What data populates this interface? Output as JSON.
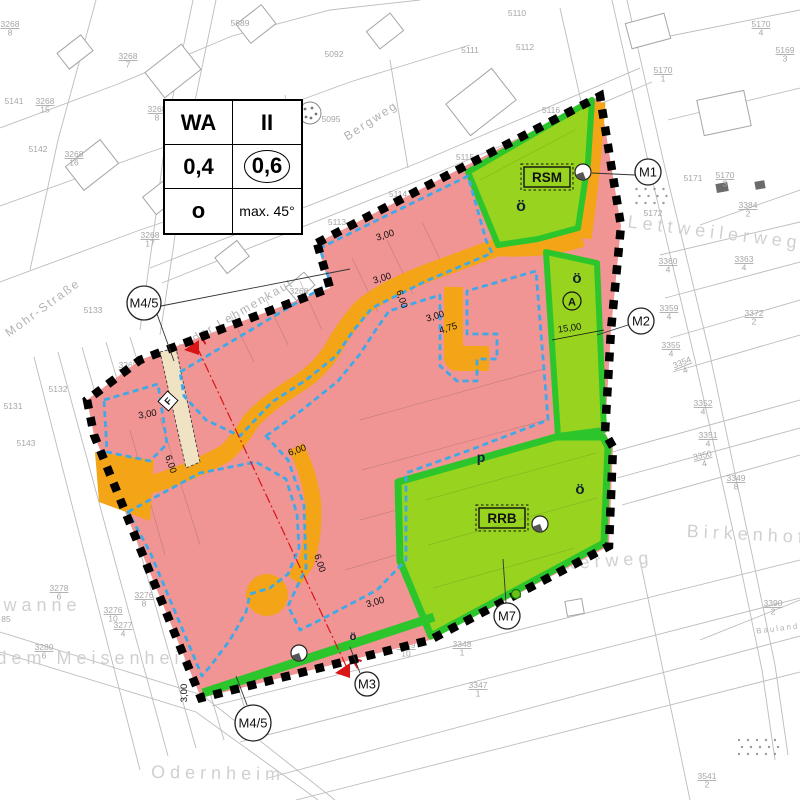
{
  "map_type": "Bebauungsplan (zoning development plan)",
  "colors": {
    "residential_pink": "#f19494",
    "road_orange": "#f3a517",
    "green_fill": "#97d31f",
    "green_band": "#2cc62c",
    "building_limit_blue": "#3fa9e8",
    "section_red": "#d91616",
    "boundary_black": "#000000",
    "cadastre_gray": "#bcbcbc",
    "label_gray": "#a6a6a6",
    "footpath_cream": "#efe3c4"
  },
  "legend": {
    "rows": [
      {
        "left": "WA",
        "right": "II"
      },
      {
        "left": "0,4",
        "right": "0,6"
      },
      {
        "left": "o",
        "right": "max. 45°"
      }
    ]
  },
  "area_boxes": {
    "rsm": {
      "label": "RSM",
      "x": 547,
      "y": 177
    },
    "rrb": {
      "label": "RRB",
      "x": 502,
      "y": 518
    }
  },
  "green_labels": [
    {
      "t": "ö",
      "x": 521,
      "y": 211,
      "s": 16
    },
    {
      "t": "ö",
      "x": 577,
      "y": 283,
      "s": 15
    },
    {
      "t": "ö",
      "x": 580,
      "y": 494,
      "s": 15
    },
    {
      "t": "ö",
      "x": 353,
      "y": 640,
      "s": 11
    },
    {
      "t": "p",
      "x": 481,
      "y": 462,
      "s": 14
    }
  ],
  "circled_a": {
    "label": "A",
    "x": 572,
    "y": 301
  },
  "f_symbol": {
    "label": "F",
    "x": 168,
    "y": 401
  },
  "section_markers": {
    "label": "A",
    "line": [
      [
        197,
        347
      ],
      [
        348,
        670
      ]
    ],
    "triangles": [
      {
        "x": 197,
        "y": 347,
        "ax": 208,
        "ay": 340
      },
      {
        "x": 348,
        "y": 670,
        "ax": 360,
        "ay": 664
      }
    ]
  },
  "markers": [
    {
      "label": "M1",
      "x": 648,
      "y": 172,
      "r": 13,
      "leaders": [
        [
          [
            635,
            175
          ],
          [
            592,
            173
          ]
        ]
      ]
    },
    {
      "label": "M2",
      "x": 641,
      "y": 321,
      "r": 13,
      "leaders": [
        [
          [
            628,
            325
          ],
          [
            597,
            335
          ]
        ]
      ]
    },
    {
      "label": "M3",
      "x": 367,
      "y": 684,
      "r": 12,
      "leaders": [
        [
          [
            360,
            673
          ],
          [
            350,
            647
          ]
        ]
      ]
    },
    {
      "label": "M4/5",
      "x": 144,
      "y": 303,
      "r": 17,
      "leaders": [
        [
          [
            157,
            314
          ],
          [
            174,
            361
          ]
        ],
        [
          [
            161,
            306
          ],
          [
            350,
            269
          ]
        ]
      ]
    },
    {
      "label": "M4/5",
      "x": 253,
      "y": 723,
      "r": 18,
      "leaders": [
        [
          [
            247,
            705
          ],
          [
            236,
            676
          ]
        ]
      ]
    },
    {
      "label": "M7",
      "x": 507,
      "y": 616,
      "r": 13,
      "leaders": [
        [
          [
            506,
            603
          ],
          [
            503,
            559
          ]
        ]
      ]
    }
  ],
  "dimensions": [
    {
      "t": "3,00",
      "x": 386,
      "y": 238,
      "r": -17
    },
    {
      "t": "3,00",
      "x": 383,
      "y": 281,
      "r": -17
    },
    {
      "t": "6,00",
      "x": 399,
      "y": 300,
      "r": 72
    },
    {
      "t": "3,00",
      "x": 436,
      "y": 319,
      "r": -17
    },
    {
      "t": "4,75",
      "x": 449,
      "y": 331,
      "r": -17
    },
    {
      "t": "15,00",
      "x": 570,
      "y": 331,
      "r": -8
    },
    {
      "t": "3,00",
      "x": 148,
      "y": 417,
      "r": -10
    },
    {
      "t": "6,00",
      "x": 168,
      "y": 465,
      "r": 72
    },
    {
      "t": "6,00",
      "x": 298,
      "y": 453,
      "r": -18
    },
    {
      "t": "6,00",
      "x": 317,
      "y": 564,
      "r": 72
    },
    {
      "t": "3,00",
      "x": 376,
      "y": 605,
      "r": -16
    },
    {
      "t": "3,00",
      "x": 187,
      "y": 693,
      "r": -90
    }
  ],
  "street_names": [
    {
      "t": "Bergweg",
      "x": 373,
      "y": 124,
      "r": -33,
      "size": "sm"
    },
    {
      "t": "Mohr-Straße",
      "x": 45,
      "y": 311,
      "r": -36,
      "size": "sm"
    },
    {
      "t": "Auf der Lehmenkaut",
      "x": 232,
      "y": 321,
      "r": -30,
      "size": "sm"
    },
    {
      "t": "Lettweilerweg",
      "x": 714,
      "y": 238,
      "r": 7,
      "size": "lg"
    },
    {
      "t": "Birkenhof",
      "x": 747,
      "y": 540,
      "r": 3,
      "size": "lg"
    },
    {
      "t": "Odernheim",
      "x": 218,
      "y": 779,
      "r": 1,
      "size": "lg"
    },
    {
      "t": "dem Meisenheimer",
      "x": 113,
      "y": 664,
      "r": 0,
      "size": "lg"
    },
    {
      "t": "ewanne",
      "x": 35,
      "y": 611,
      "r": 0,
      "size": "lg"
    },
    {
      "t": "Am Leinackerweg",
      "x": 545,
      "y": 571,
      "r": -4,
      "size": "lg"
    },
    {
      "t": "Bauland",
      "x": 778,
      "y": 631,
      "r": -7,
      "size": "xs"
    }
  ],
  "parcel_labels": [
    {
      "t": "3268/8",
      "x": 10,
      "y": 27
    },
    {
      "t": "5889",
      "x": 240,
      "y": 26
    },
    {
      "t": "3268/7",
      "x": 128,
      "y": 59
    },
    {
      "t": "5141",
      "x": 14,
      "y": 104
    },
    {
      "t": "3268/15",
      "x": 45,
      "y": 104
    },
    {
      "t": "3268/8",
      "x": 157,
      "y": 112
    },
    {
      "t": "5142",
      "x": 38,
      "y": 152
    },
    {
      "t": "3268/16",
      "x": 74,
      "y": 157
    },
    {
      "t": "3268/17",
      "x": 150,
      "y": 238
    },
    {
      "t": "5092",
      "x": 334,
      "y": 57
    },
    {
      "t": "5095",
      "x": 331,
      "y": 122
    },
    {
      "t": "5110",
      "x": 517,
      "y": 16
    },
    {
      "t": "5111",
      "x": 470,
      "y": 53
    },
    {
      "t": "5112",
      "x": 525,
      "y": 50
    },
    {
      "t": "5113",
      "x": 337,
      "y": 225
    },
    {
      "t": "5114",
      "x": 398,
      "y": 197
    },
    {
      "t": "5115",
      "x": 465,
      "y": 160
    },
    {
      "t": "5116",
      "x": 551,
      "y": 113
    },
    {
      "t": "5170/1",
      "x": 663,
      "y": 73
    },
    {
      "t": "5170/4",
      "x": 761,
      "y": 27
    },
    {
      "t": "5169/3",
      "x": 785,
      "y": 53
    },
    {
      "t": "5171",
      "x": 693,
      "y": 181
    },
    {
      "t": "5170/3",
      "x": 725,
      "y": 178
    },
    {
      "t": "5172",
      "x": 653,
      "y": 216
    },
    {
      "t": "3384/2",
      "x": 748,
      "y": 208
    },
    {
      "t": "3363/4",
      "x": 744,
      "y": 262
    },
    {
      "t": "3360/4",
      "x": 668,
      "y": 264
    },
    {
      "t": "3372/2",
      "x": 754,
      "y": 316
    },
    {
      "t": "3359/4",
      "x": 669,
      "y": 311
    },
    {
      "t": "3355/4",
      "x": 671,
      "y": 348
    },
    {
      "t": "3354/4",
      "x": 683,
      "y": 365,
      "r": -22
    },
    {
      "t": "3352/4",
      "x": 703,
      "y": 406
    },
    {
      "t": "3351/4",
      "x": 708,
      "y": 438
    },
    {
      "t": "3350/4",
      "x": 703,
      "y": 458,
      "r": -13
    },
    {
      "t": "3349/8",
      "x": 736,
      "y": 481
    },
    {
      "t": "3390/2",
      "x": 773,
      "y": 606
    },
    {
      "t": "3541/2",
      "x": 707,
      "y": 779
    },
    {
      "t": "3349/10",
      "x": 406,
      "y": 648
    },
    {
      "t": "3348/1",
      "x": 462,
      "y": 647
    },
    {
      "t": "3347/1",
      "x": 478,
      "y": 688
    },
    {
      "t": "3280/6",
      "x": 44,
      "y": 650
    },
    {
      "t": "3277/4",
      "x": 123,
      "y": 628
    },
    {
      "t": "3276/10",
      "x": 113,
      "y": 613
    },
    {
      "t": "3276/8",
      "x": 144,
      "y": 598
    },
    {
      "t": "3278/6",
      "x": 59,
      "y": 591
    },
    {
      "t": "85",
      "x": 6,
      "y": 622
    },
    {
      "t": "5131",
      "x": 13,
      "y": 409
    },
    {
      "t": "5132",
      "x": 58,
      "y": 392
    },
    {
      "t": "5133",
      "x": 93,
      "y": 313
    },
    {
      "t": "5143",
      "x": 26,
      "y": 446
    },
    {
      "t": "3268/22",
      "x": 128,
      "y": 368
    },
    {
      "t": "3268/21",
      "x": 178,
      "y": 352
    },
    {
      "t": "3268",
      "x": 299,
      "y": 294
    }
  ],
  "survey_points": [
    {
      "x": 583,
      "y": 172
    },
    {
      "x": 540,
      "y": 524
    },
    {
      "x": 299,
      "y": 653
    }
  ],
  "tree_symbols": [
    {
      "x": 516,
      "y": 594
    }
  ]
}
